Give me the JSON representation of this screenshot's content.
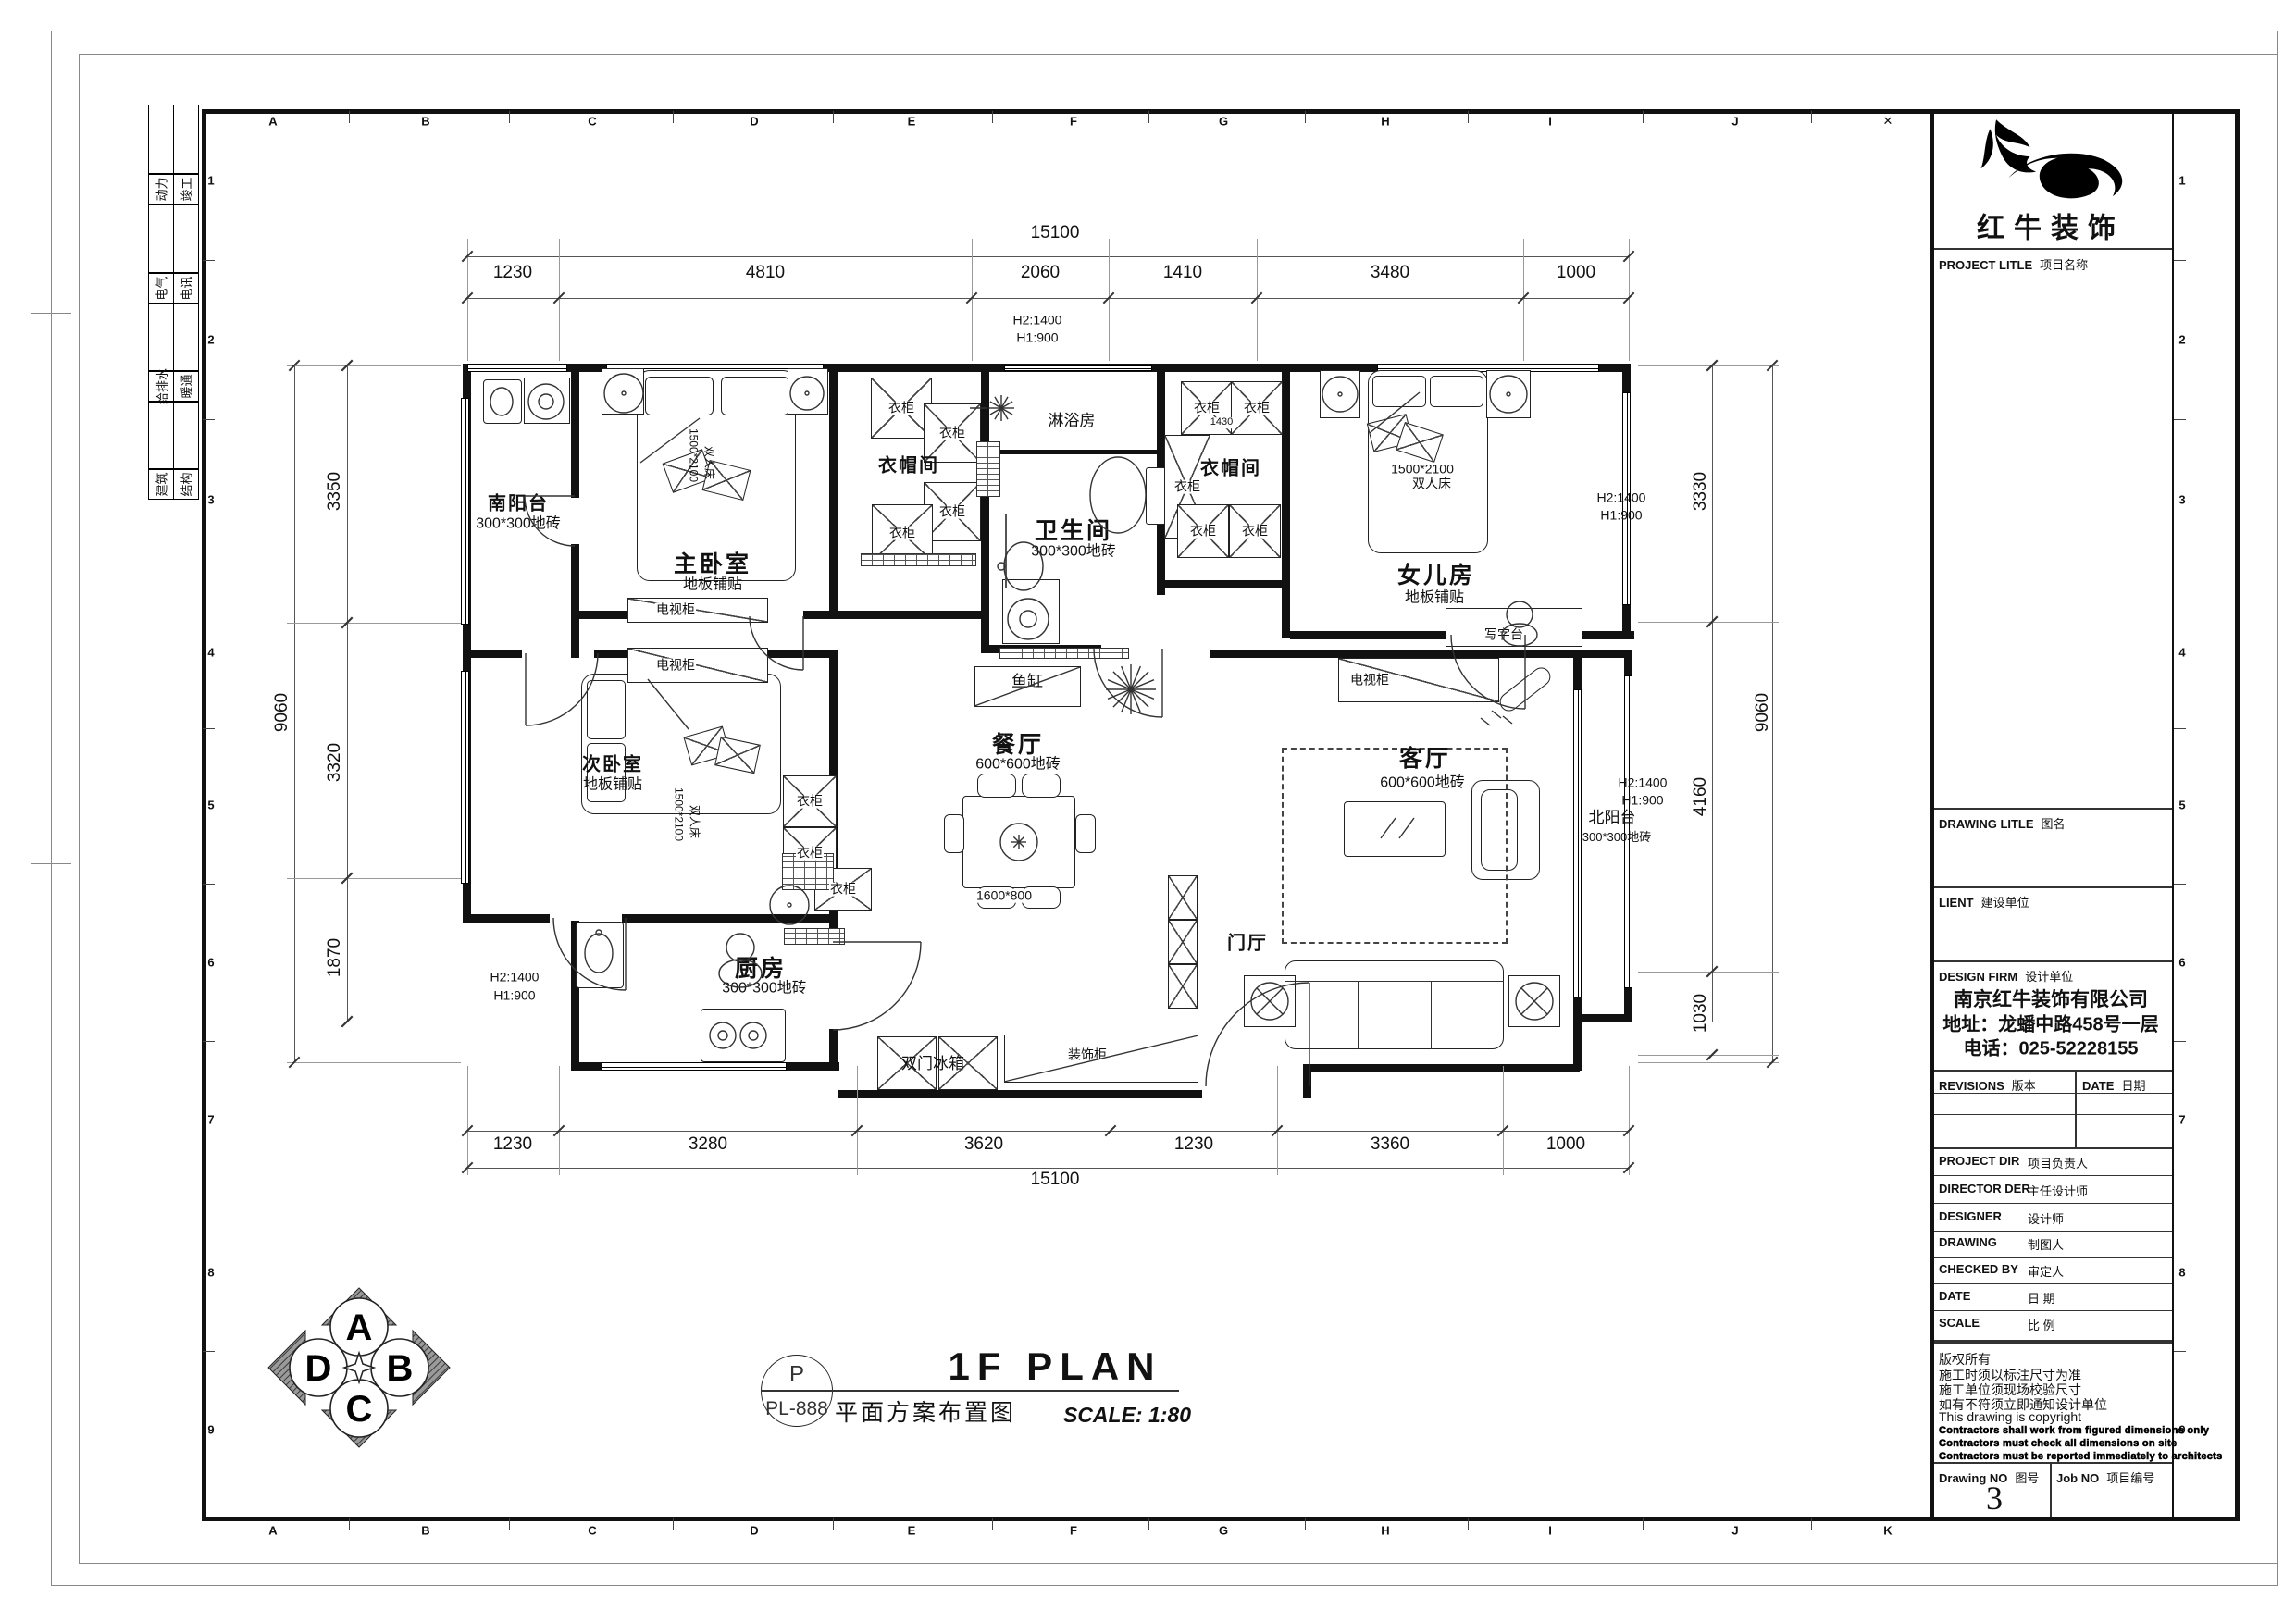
{
  "sheet": {
    "grid_letters_top": [
      "A",
      "B",
      "C",
      "D",
      "E",
      "F",
      "G",
      "H",
      "I",
      "J",
      "✕"
    ],
    "grid_letters_bottom": [
      "A",
      "B",
      "C",
      "D",
      "E",
      "F",
      "G",
      "H",
      "I",
      "J",
      "K"
    ],
    "grid_numbers": [
      "1",
      "2",
      "3",
      "4",
      "5",
      "6",
      "7",
      "8",
      "9"
    ]
  },
  "disciplines": [
    {
      "left": "动力",
      "right": "竣工"
    },
    {
      "left": "电气",
      "right": "电讯"
    },
    {
      "left": "给排水",
      "right": "暖通"
    },
    {
      "left": "建筑",
      "right": "结构"
    }
  ],
  "title_block": {
    "brand": "红牛装饰",
    "project_label_en": "PROJECT LITLE",
    "project_label_cn": "项目名称",
    "drawing_label_en": "DRAWING LITLE",
    "drawing_label_cn": "图名",
    "client_label_en": "LIENT",
    "client_label_cn": "建设单位",
    "firm_label_en": "DESIGN FIRM",
    "firm_label_cn": "设计单位",
    "firm_name": "南京红牛装饰有限公司",
    "firm_address": "地址：龙蟠中路458号一层",
    "firm_phone": "电话：025-52228155",
    "revisions_label_en": "REVISIONS",
    "revisions_label_cn": "版本",
    "date_col_en": "DATE",
    "date_col_cn": "日期",
    "rows": [
      {
        "en": "PROJECT DIR",
        "cn": "项目负责人"
      },
      {
        "en": "DIRECTOR DER",
        "cn": "主任设计师"
      },
      {
        "en": "DESIGNER",
        "cn": "设计师"
      },
      {
        "en": "DRAWING",
        "cn": "制图人"
      },
      {
        "en": "CHECKED BY",
        "cn": "审定人"
      },
      {
        "en": "DATE",
        "cn": "日  期"
      },
      {
        "en": "SCALE",
        "cn": "比  例"
      }
    ],
    "notes": [
      "版权所有",
      "施工时须以标注尺寸为准",
      "施工单位须现场校验尺寸",
      "如有不符须立即通知设计单位",
      "This drawing is copyright"
    ],
    "notes_bold": [
      "Contractors shall work from figured dimensions only",
      "Contractors must check all dimensions on site",
      "Contractors must be reported immediately to architects"
    ],
    "drawing_no_label_en": "Drawing NO",
    "drawing_no_label_cn": "图号",
    "drawing_no": "3",
    "job_no_label_en": "Job NO",
    "job_no_label_cn": "项目编号"
  },
  "title_bar": {
    "tag_letter": "P",
    "tag_code": "PL-888",
    "title": "1F PLAN",
    "subtitle": "平面方案布置图",
    "scale": "SCALE: 1:80"
  },
  "compass": {
    "north": "A",
    "east": "B",
    "south": "C",
    "west": "D"
  },
  "plan": {
    "labels": [
      "15100",
      "1230",
      "4810",
      "2060",
      "1410",
      "3480",
      "1000",
      "H2:1400",
      "H1:900",
      "3350",
      "3320",
      "1870",
      "9060",
      "3330",
      "4160",
      "1030",
      "9060",
      "H2:1400",
      "H1:900",
      "H2:1400",
      "H1:900",
      "H2:1400",
      "H1:900",
      "1230",
      "3280",
      "3620",
      "1230",
      "3360",
      "1000",
      "15100",
      "南阳台",
      "300*300地砖",
      "主卧室",
      "地板铺贴",
      "衣帽间",
      "淋浴房",
      "卫生间",
      "300*300地砖",
      "衣帽间",
      "女儿房",
      "地板铺贴",
      "次卧室",
      "地板铺贴",
      "餐厅",
      "600*600地砖",
      "客厅",
      "600*600地砖",
      "北阳台",
      "300*300地砖",
      "厨房",
      "300*300地砖",
      "门厅",
      "1500*2100",
      "双人床",
      "写字台",
      "电视柜",
      "电视柜",
      "电视柜",
      "鱼缸",
      "1600*800",
      "双门冰箱",
      "装饰柜",
      "衣柜",
      "衣柜",
      "衣柜",
      "衣柜",
      "衣柜",
      "衣柜",
      "衣柜",
      "衣柜",
      "衣柜",
      "衣柜",
      "衣柜",
      "衣柜",
      "1430",
      "1500*2100",
      "双人床",
      "1500*2100",
      "双人床"
    ]
  }
}
